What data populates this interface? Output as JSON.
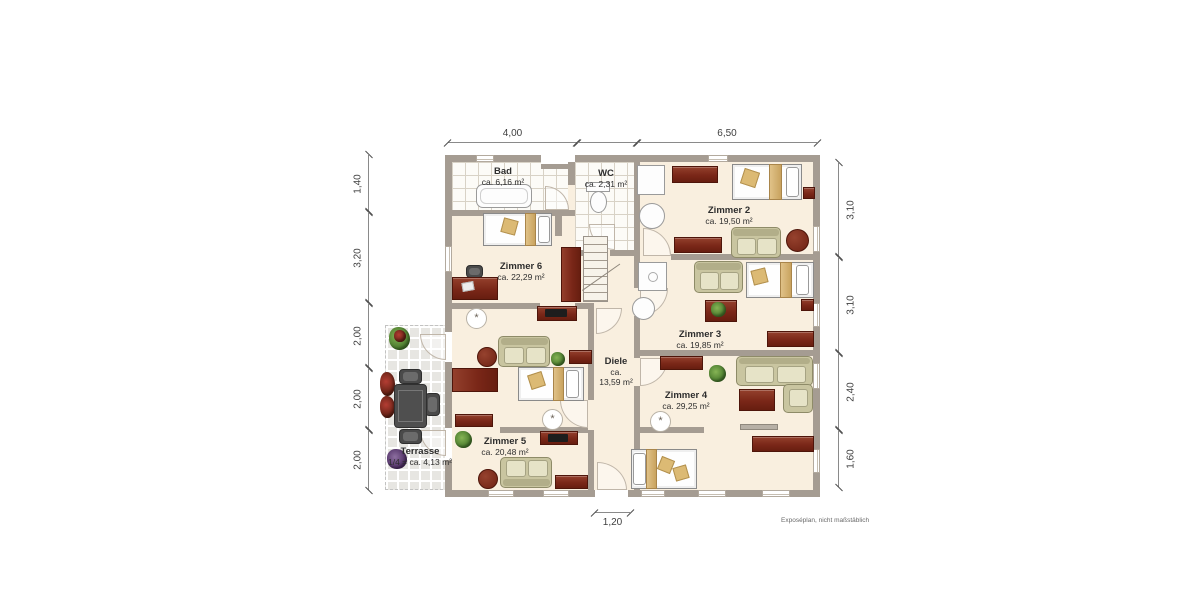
{
  "plan": {
    "disclaimer": "Exposéplan, nicht maßstäblich",
    "rooms": {
      "bad": {
        "name": "Bad",
        "area": "ca. 6,16 m²"
      },
      "wc": {
        "name": "WC",
        "area": "ca. 2,31 m²"
      },
      "zimmer2": {
        "name": "Zimmer 2",
        "area": "ca. 19,50 m²"
      },
      "zimmer3": {
        "name": "Zimmer 3",
        "area": "ca. 19,85 m²"
      },
      "zimmer4": {
        "name": "Zimmer 4",
        "area": "ca. 29,25 m²"
      },
      "zimmer5": {
        "name": "Zimmer 5",
        "area": "ca. 20,48 m²"
      },
      "zimmer6": {
        "name": "Zimmer 6",
        "area": "ca. 22,29 m²"
      },
      "diele": {
        "name": "Diele",
        "area_prefix": "ca.",
        "area_value": "13,59 m²"
      },
      "terrasse": {
        "name": "Terrasse",
        "area": "1/4 = ca. 4,13 m²"
      }
    },
    "dimensions": {
      "top": [
        "4,00",
        "6,50"
      ],
      "bottom": [
        "1,20"
      ],
      "left": [
        "1,40",
        "3,20",
        "2,00",
        "2,00",
        "2,00"
      ],
      "right": [
        "3,10",
        "3,10",
        "2,40",
        "1,60"
      ]
    },
    "colors": {
      "wall": "#a59c92",
      "floor": "#f9efdf",
      "wood": "#7a2718",
      "accent_tan": "#d7b87a",
      "sofa": "#c9c5a0",
      "terrace_tile": "#e7e6e2"
    }
  }
}
